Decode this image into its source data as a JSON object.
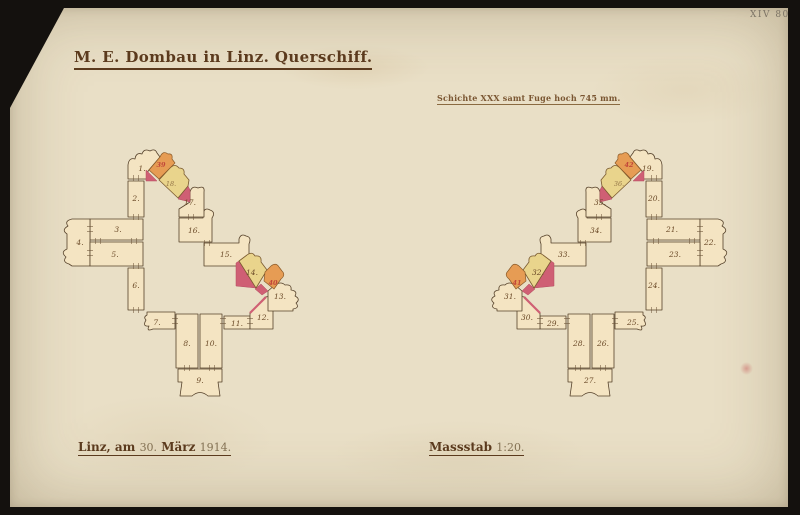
{
  "corner_mark": "XIV 80",
  "title": "M. E. Dombau in Linz. Querschiff.",
  "subtitle": "Schichte XXX samt Fuge hoch 745 mm.",
  "footer": {
    "place_date": {
      "prefix": "Linz, am",
      "day": "30.",
      "month": "März",
      "year": "1914."
    },
    "scale": {
      "label": "Massstab",
      "value": "1:20."
    }
  },
  "left_plan": {
    "stones": [
      "1.",
      "2.",
      "3.",
      "4.",
      "5.",
      "6.",
      "7.",
      "8.",
      "9.",
      "10.",
      "11.",
      "12.",
      "13.",
      "14.",
      "15.",
      "16.",
      "17.",
      "18."
    ],
    "red_marks": [
      "39",
      "40"
    ]
  },
  "right_plan": {
    "stones": [
      "19.",
      "20.",
      "21.",
      "22.",
      "23.",
      "24.",
      "25.",
      "26.",
      "27.",
      "28.",
      "29.",
      "30.",
      "31.",
      "32.",
      "33.",
      "34.",
      "35.",
      "36."
    ],
    "red_marks": [
      "41",
      "42"
    ]
  },
  "colors": {
    "paper": "#e9dfc6",
    "background": "#14110e",
    "stone": "#f4e4c2",
    "yellow": "#e9d48c",
    "orange": "#e69c54",
    "pink": "#cf5f74",
    "ink": "#55412a",
    "title_ink": "#5b3a1d",
    "red_mark": "#c2463a"
  }
}
